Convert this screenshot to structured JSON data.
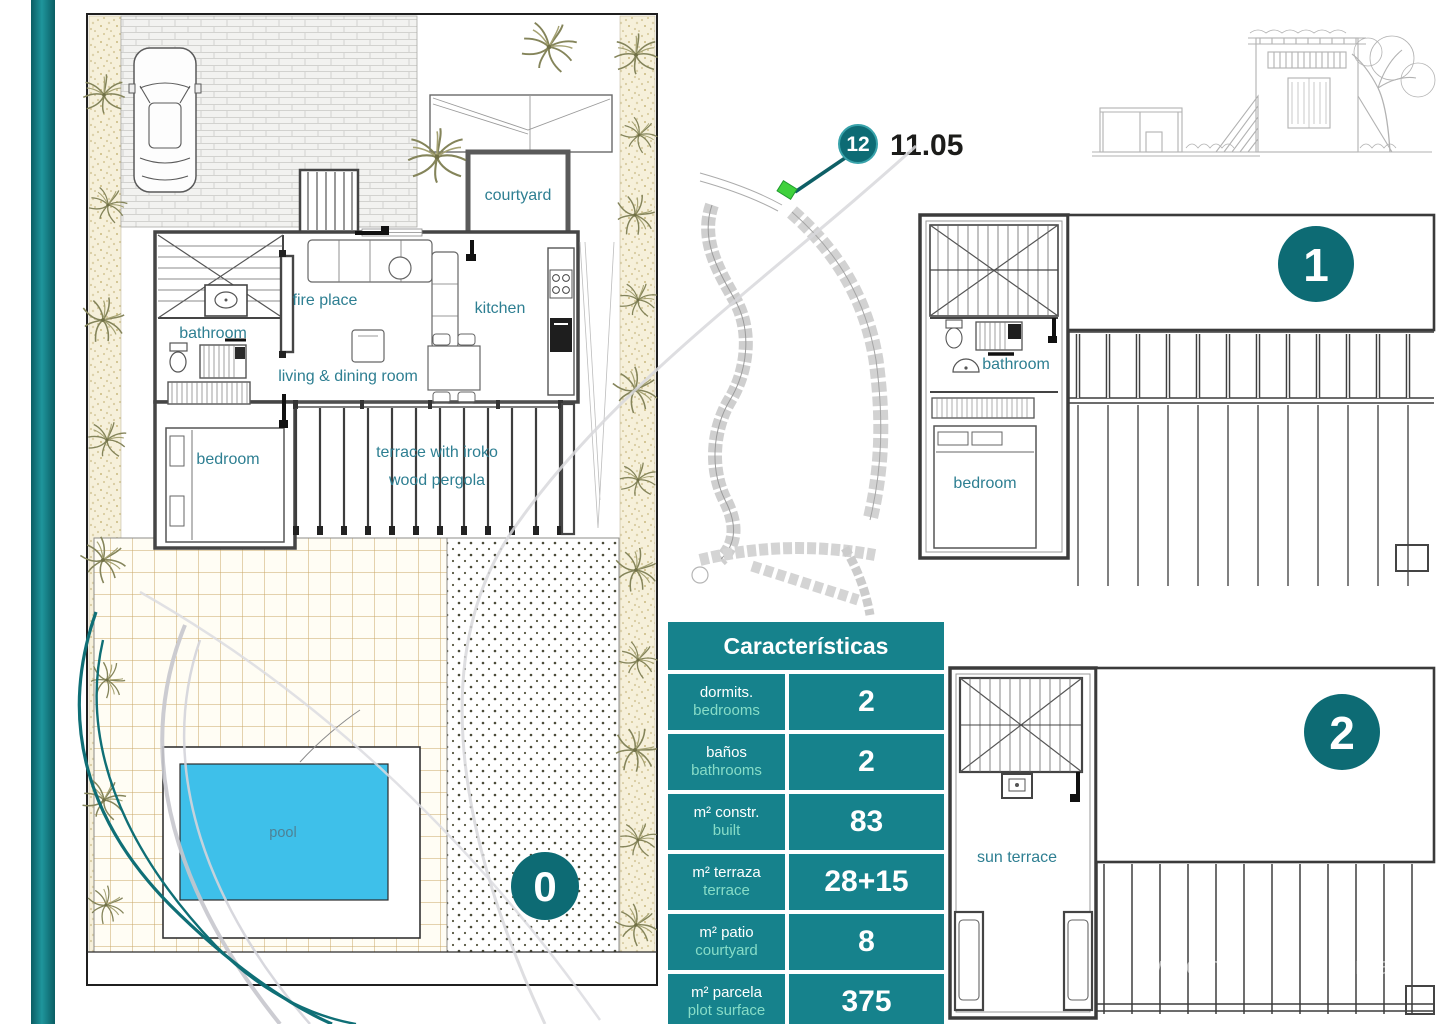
{
  "ground_floor": {
    "badge": "0",
    "labels": {
      "bathroom": "bathroom",
      "fire_place": "fire place",
      "courtyard": "courtyard",
      "kitchen": "kitchen",
      "living_dining": "living & dining room",
      "bedroom": "bedroom",
      "terrace_line1": "terrace with iroko",
      "terrace_line2": "wood pergola",
      "pool": "pool"
    }
  },
  "site_map": {
    "badge": "12",
    "elevation_label": "11.05"
  },
  "floor_1": {
    "badge": "1",
    "labels": {
      "bathroom": "bathroom",
      "bedroom": "bedroom"
    }
  },
  "floor_2": {
    "badge": "2",
    "labels": {
      "sun_terrace": "sun terrace"
    }
  },
  "characteristics": {
    "title": "Características",
    "rows": [
      {
        "label_es": "dormits.",
        "label_en": "bedrooms",
        "value": "2"
      },
      {
        "label_es": "baños",
        "label_en": "bathrooms",
        "value": "2"
      },
      {
        "label_es": "m² constr.",
        "label_en": "built",
        "value": "83"
      },
      {
        "label_es": "m² terraza",
        "label_en": "terrace",
        "value": "28+15"
      },
      {
        "label_es": "m² patio",
        "label_en": "courtyard",
        "value": "8"
      },
      {
        "label_es": "m² parcela",
        "label_en": "plot surface",
        "value": "375"
      }
    ]
  },
  "watermark": {
    "text": "viviendas sanas"
  },
  "colors": {
    "teal_badge": "#0d6b74",
    "teal_table": "#16828c",
    "mint_text": "#87dcc7",
    "pool_blue": "#3ec0ea",
    "room_label": "#2e7f92",
    "marker_green": "#3fd13c",
    "teal_bar": "#0f6f76"
  }
}
